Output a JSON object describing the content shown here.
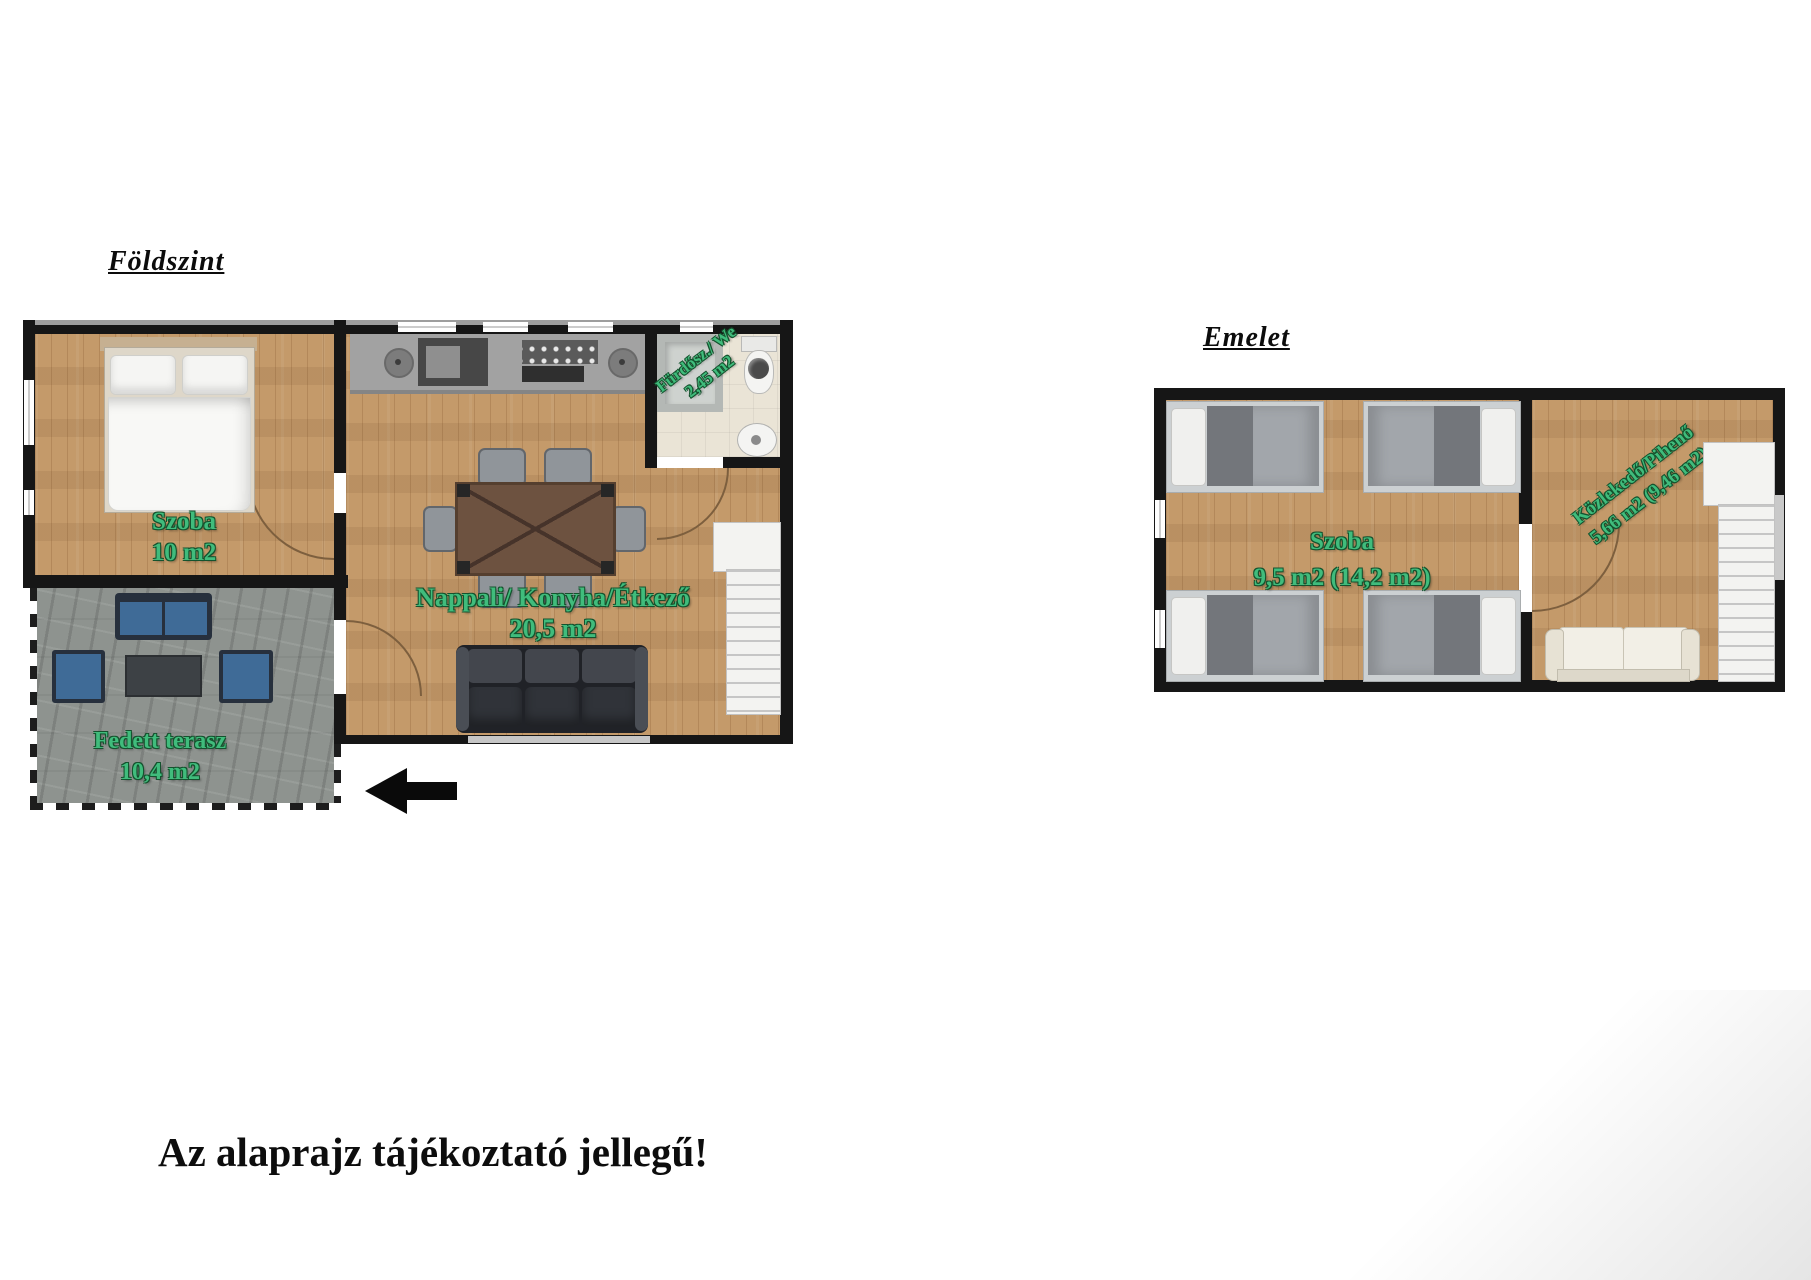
{
  "ground_floor": {
    "title": "Földszint",
    "rooms": {
      "bedroom": {
        "label": "Szoba",
        "area": "10 m2"
      },
      "living": {
        "label": "Nappali/ Konyha/Étkező",
        "area": "20,5 m2"
      },
      "bathroom": {
        "label": "Fürdősz./ We",
        "area": "2,45 m2"
      },
      "terrace": {
        "label": "Fedett terasz",
        "area": "10,4 m2"
      }
    }
  },
  "upper_floor": {
    "title": "Emelet",
    "rooms": {
      "bedroom": {
        "label": "Szoba",
        "area": "9,5 m2 (14,2 m2)"
      },
      "hallway": {
        "label": "Közlekedő/Pihenő",
        "area": "5,66 m2 (9,46 m2)"
      }
    }
  },
  "disclaimer": "Az alaprajz tájékoztató jellegű!",
  "colors": {
    "label_green": "#40bc7c",
    "wall_black": "#161616",
    "wood_floor": "#c49a6a",
    "terrace_stone": "#8e938f",
    "terrace_furniture_blue": "#3f6b97",
    "living_sofa_dark": "#2e3138",
    "upper_sofa_cream": "#f2efe6"
  }
}
